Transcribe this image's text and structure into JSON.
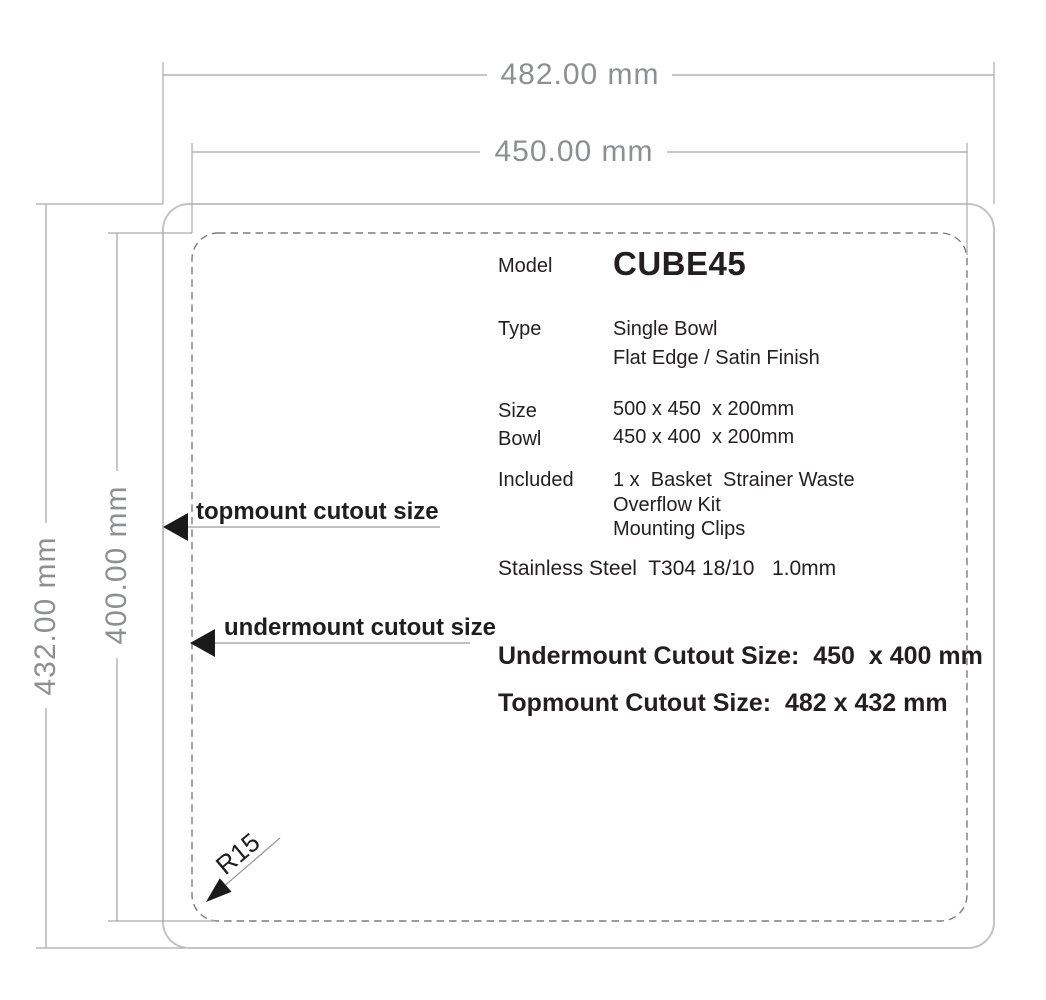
{
  "dims": {
    "top_outer": "482.00 mm",
    "top_inner": "450.00 mm",
    "left_outer": "432.00 mm",
    "left_inner": "400.00 mm"
  },
  "callouts": {
    "topmount": "topmount cutout size",
    "undermount": "undermount cutout size",
    "corner_radius": "R15"
  },
  "spec": {
    "model_label": "Model",
    "model_value": "CUBE45",
    "type_label": "Type",
    "type_value_1": "Single Bowl",
    "type_value_2": "Flat Edge / Satin Finish",
    "size_label": "Size",
    "size_value": "500 x 450  x 200mm",
    "bowl_label": "Bowl",
    "bowl_value": "450 x 400  x 200mm",
    "included_label": "Included",
    "included_value_1": "1 x  Basket  Strainer Waste",
    "included_value_2": "Overflow Kit",
    "included_value_3": "Mounting Clips",
    "material": "Stainless Steel  T304 18/10   1.0mm"
  },
  "summary": {
    "undermount": "Undermount Cutout Size:  450  x 400 mm",
    "topmount": "Topmount Cutout Size:  482 x 432 mm"
  },
  "colors": {
    "dimension_text": "#8d8f91",
    "dimension_line": "#a3a3a3",
    "topmount_outline": "#c4c4c4",
    "undermount_outline": "#7d7d7d",
    "body_text": "#231f20",
    "arrowhead": "#1a1a1a"
  }
}
